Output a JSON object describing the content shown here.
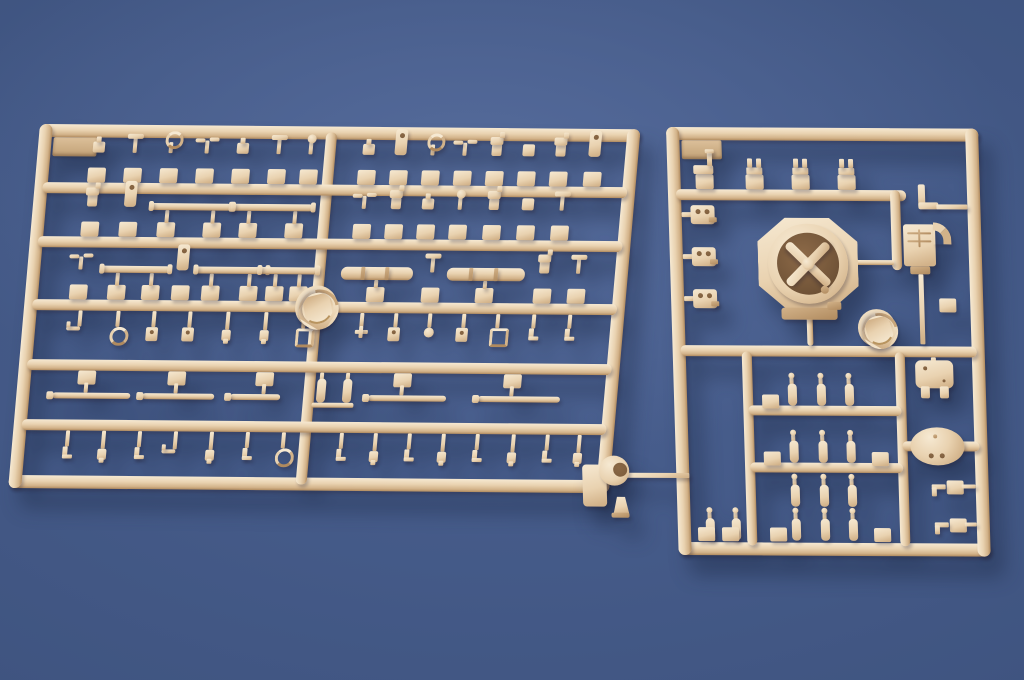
{
  "scene": {
    "width": 1024,
    "height": 680,
    "subject": "two tan plastic model-kit sprues on blue background"
  },
  "palette": {
    "bg1": "#556b9b",
    "bg2": "#4a6090",
    "bg3": "#3f5480",
    "bg4": "#344970",
    "pl_light": "#f6e9d2",
    "pl_mid": "#e9d2b0",
    "pl_dark": "#d2b289",
    "pl_deep": "#b08a5e",
    "hole": "#7c5c3c",
    "ctab1": "#dcc09a",
    "ctab2": "#c2a176"
  },
  "sprues": [
    {
      "id": "left-sprue",
      "x": 40,
      "y": 124,
      "w": 601,
      "h": 364,
      "skew": -4.5,
      "rot": 0.5,
      "corner_tab": {
        "x": 15,
        "y": 13,
        "w": 44,
        "h": 19
      },
      "discs": [
        {
          "cx": 292,
          "cy": 180,
          "r": 21
        }
      ],
      "bars": [
        {
          "x": 0,
          "y": 0,
          "w": 601,
          "h": 13,
          "o": "h",
          "r": 7
        },
        {
          "x": 0,
          "y": 351,
          "w": 601,
          "h": 13,
          "o": "h",
          "r": 7
        },
        {
          "x": 0,
          "y": 0,
          "w": 13,
          "h": 364,
          "o": "v",
          "r": 7
        },
        {
          "x": 588,
          "y": 0,
          "w": 13,
          "h": 364,
          "o": "v",
          "r": 7
        },
        {
          "x": 287,
          "y": 6,
          "w": 11,
          "h": 352,
          "o": "v",
          "r": 5
        },
        {
          "x": 8,
          "y": 58,
          "w": 585,
          "h": 11,
          "o": "h",
          "r": 5
        },
        {
          "x": 8,
          "y": 112,
          "w": 585,
          "h": 11,
          "o": "h",
          "r": 5
        },
        {
          "x": 8,
          "y": 175,
          "w": 585,
          "h": 11,
          "o": "h",
          "r": 5
        },
        {
          "x": 8,
          "y": 235,
          "w": 585,
          "h": 11,
          "o": "h",
          "r": 5
        },
        {
          "x": 8,
          "y": 295,
          "w": 585,
          "h": 11,
          "o": "h",
          "r": 5
        }
      ],
      "parts": [
        {
          "t": "peri",
          "x": 52,
          "y": 58,
          "head": "nub"
        },
        {
          "t": "peri",
          "x": 88,
          "y": 58,
          "head": "tee"
        },
        {
          "t": "peri",
          "x": 124,
          "y": 58,
          "head": "ring"
        },
        {
          "t": "peri",
          "x": 160,
          "y": 58,
          "head": "wing"
        },
        {
          "t": "peri",
          "x": 196,
          "y": 58,
          "head": "nub"
        },
        {
          "t": "peri",
          "x": 232,
          "y": 58,
          "head": "tee"
        },
        {
          "t": "peri",
          "x": 264,
          "y": 58,
          "head": "ball"
        },
        {
          "t": "peri",
          "x": 322,
          "y": 58,
          "head": "nub"
        },
        {
          "t": "peri",
          "x": 354,
          "y": 58,
          "head": "tall"
        },
        {
          "t": "peri",
          "x": 386,
          "y": 58,
          "head": "ring"
        },
        {
          "t": "peri",
          "x": 418,
          "y": 58,
          "head": "wing"
        },
        {
          "t": "peri",
          "x": 450,
          "y": 58,
          "head": "fig"
        },
        {
          "t": "peri",
          "x": 482,
          "y": 58,
          "head": "sq"
        },
        {
          "t": "peri",
          "x": 514,
          "y": 58,
          "head": "fig"
        },
        {
          "t": "peri",
          "x": 548,
          "y": 58,
          "head": "tall"
        },
        {
          "t": "peri",
          "x": 50,
          "y": 112,
          "head": "fig"
        },
        {
          "t": "peri",
          "x": 88,
          "y": 112,
          "head": "tall"
        },
        {
          "t": "barpart",
          "x": 126,
          "y": 112,
          "w": 64
        },
        {
          "t": "barpart",
          "x": 208,
          "y": 112,
          "w": 64
        },
        {
          "t": "peri",
          "x": 322,
          "y": 112,
          "head": "wing"
        },
        {
          "t": "peri",
          "x": 354,
          "y": 112,
          "head": "fig"
        },
        {
          "t": "peri",
          "x": 386,
          "y": 112,
          "head": "nub"
        },
        {
          "t": "peri",
          "x": 418,
          "y": 112,
          "head": "ball"
        },
        {
          "t": "peri",
          "x": 452,
          "y": 112,
          "head": "fig"
        },
        {
          "t": "peri",
          "x": 486,
          "y": 112,
          "head": "sq"
        },
        {
          "t": "peri",
          "x": 520,
          "y": 112,
          "head": "tee"
        },
        {
          "t": "peri",
          "x": 44,
          "y": 175,
          "head": "wing"
        },
        {
          "t": "barpart",
          "x": 82,
          "y": 175,
          "w": 52
        },
        {
          "t": "peri",
          "x": 146,
          "y": 175,
          "head": "tall"
        },
        {
          "t": "barpart",
          "x": 176,
          "y": 175,
          "w": 56
        },
        {
          "t": "barpart",
          "x": 240,
          "y": 175,
          "w": 42
        },
        {
          "t": "pipebar",
          "x": 318,
          "y": 175,
          "w": 64
        },
        {
          "t": "peri",
          "x": 396,
          "y": 175,
          "head": "tee"
        },
        {
          "t": "pipebar",
          "x": 424,
          "y": 175,
          "w": 70
        },
        {
          "t": "peri",
          "x": 508,
          "y": 175,
          "head": "fig"
        },
        {
          "t": "peri",
          "x": 542,
          "y": 175,
          "head": "tee"
        },
        {
          "t": "hang",
          "x": 48,
          "y": 186,
          "len": 16,
          "head": "hook"
        },
        {
          "t": "hang",
          "x": 86,
          "y": 186,
          "len": 16,
          "head": "washer"
        },
        {
          "t": "hang",
          "x": 122,
          "y": 186,
          "len": 16,
          "head": "clip"
        },
        {
          "t": "hang",
          "x": 158,
          "y": 186,
          "len": 16,
          "head": "clip"
        },
        {
          "t": "hang",
          "x": 196,
          "y": 186,
          "len": 18,
          "head": "fig"
        },
        {
          "t": "hang",
          "x": 234,
          "y": 186,
          "len": 18,
          "head": "fig"
        },
        {
          "t": "hang",
          "x": 272,
          "y": 186,
          "len": 16,
          "head": "sqring"
        },
        {
          "t": "hang",
          "x": 330,
          "y": 186,
          "len": 14,
          "head": "cross"
        },
        {
          "t": "hang",
          "x": 364,
          "y": 186,
          "len": 14,
          "head": "clip"
        },
        {
          "t": "hang",
          "x": 398,
          "y": 186,
          "len": 14,
          "head": "ball"
        },
        {
          "t": "hang",
          "x": 432,
          "y": 186,
          "len": 14,
          "head": "clip"
        },
        {
          "t": "hang",
          "x": 466,
          "y": 186,
          "len": 14,
          "head": "sqring"
        },
        {
          "t": "hang",
          "x": 502,
          "y": 186,
          "len": 14,
          "head": "boot"
        },
        {
          "t": "hang",
          "x": 538,
          "y": 186,
          "len": 14,
          "head": "boot"
        },
        {
          "t": "longgun",
          "x": 52,
          "y": 246,
          "w": 78
        },
        {
          "t": "longgun",
          "x": 142,
          "y": 246,
          "w": 72
        },
        {
          "t": "longgun",
          "x": 230,
          "y": 246,
          "w": 50
        },
        {
          "t": "axlepair",
          "x": 300,
          "y": 246
        },
        {
          "t": "longgun",
          "x": 368,
          "y": 246,
          "w": 78
        },
        {
          "t": "longgun",
          "x": 478,
          "y": 246,
          "w": 82
        },
        {
          "t": "hang",
          "x": 46,
          "y": 306,
          "len": 16,
          "head": "boot"
        },
        {
          "t": "hang",
          "x": 82,
          "y": 306,
          "len": 18,
          "head": "fig"
        },
        {
          "t": "hang",
          "x": 118,
          "y": 306,
          "len": 16,
          "head": "boot"
        },
        {
          "t": "hang",
          "x": 154,
          "y": 306,
          "len": 18,
          "head": "hook"
        },
        {
          "t": "hang",
          "x": 190,
          "y": 306,
          "len": 18,
          "head": "fig"
        },
        {
          "t": "hang",
          "x": 226,
          "y": 306,
          "len": 16,
          "head": "boot"
        },
        {
          "t": "hang",
          "x": 262,
          "y": 306,
          "len": 16,
          "head": "washer"
        },
        {
          "t": "hang",
          "x": 320,
          "y": 306,
          "len": 16,
          "head": "boot"
        },
        {
          "t": "hang",
          "x": 354,
          "y": 306,
          "len": 18,
          "head": "fig"
        },
        {
          "t": "hang",
          "x": 388,
          "y": 306,
          "len": 16,
          "head": "boot"
        },
        {
          "t": "hang",
          "x": 422,
          "y": 306,
          "len": 18,
          "head": "fig"
        },
        {
          "t": "hang",
          "x": 456,
          "y": 306,
          "len": 16,
          "head": "boot"
        },
        {
          "t": "hang",
          "x": 492,
          "y": 306,
          "len": 18,
          "head": "fig"
        },
        {
          "t": "hang",
          "x": 526,
          "y": 306,
          "len": 16,
          "head": "boot"
        },
        {
          "t": "hang",
          "x": 558,
          "y": 306,
          "len": 18,
          "head": "fig"
        }
      ]
    },
    {
      "id": "right-sprue",
      "x": 666,
      "y": 127,
      "w": 312,
      "h": 428,
      "skew": 2,
      "rot": 0.3,
      "corner_tab": {
        "x": 15,
        "y": 13,
        "w": 40,
        "h": 19
      },
      "discs": [
        {
          "cx": 205,
          "cy": 200,
          "r": 19
        }
      ],
      "bars": [
        {
          "x": 0,
          "y": 0,
          "w": 312,
          "h": 13,
          "o": "h",
          "r": 7
        },
        {
          "x": 0,
          "y": 415,
          "w": 312,
          "h": 13,
          "o": "h",
          "r": 7
        },
        {
          "x": 0,
          "y": 0,
          "w": 13,
          "h": 428,
          "o": "v",
          "r": 7
        },
        {
          "x": 299,
          "y": 0,
          "w": 13,
          "h": 428,
          "o": "v",
          "r": 7
        },
        {
          "x": 8,
          "y": 62,
          "w": 230,
          "h": 11,
          "o": "h",
          "r": 5
        },
        {
          "x": 222,
          "y": 62,
          "w": 10,
          "h": 80,
          "o": "v",
          "r": 5
        },
        {
          "x": 8,
          "y": 218,
          "w": 296,
          "h": 11,
          "o": "h",
          "r": 5
        },
        {
          "x": 69,
          "y": 224,
          "w": 10,
          "h": 194,
          "o": "v",
          "r": 5
        },
        {
          "x": 222,
          "y": 224,
          "w": 10,
          "h": 194,
          "o": "v",
          "r": 5
        },
        {
          "x": 74,
          "y": 278,
          "w": 153,
          "h": 10,
          "o": "h",
          "r": 5
        },
        {
          "x": 74,
          "y": 335,
          "w": 153,
          "h": 10,
          "o": "h",
          "r": 5
        },
        {
          "x": 227,
          "y": 313,
          "w": 77,
          "h": 10,
          "o": "h",
          "r": 5
        },
        {
          "x": 135,
          "y": 186,
          "w": 6,
          "h": 32,
          "o": "v",
          "r": 3
        },
        {
          "x": 184,
          "y": 132,
          "w": 40,
          "h": 5,
          "o": "h",
          "r": 2
        }
      ],
      "parts": [
        {
          "t": "bench",
          "x": 28,
          "y": 62
        },
        {
          "t": "prong",
          "x": 78,
          "y": 62
        },
        {
          "t": "prong",
          "x": 124,
          "y": 62
        },
        {
          "t": "prong",
          "x": 170,
          "y": 62
        },
        {
          "t": "clip2",
          "x": 13,
          "y": 78
        },
        {
          "t": "clip2",
          "x": 13,
          "y": 120
        },
        {
          "t": "clip2",
          "x": 13,
          "y": 162
        },
        {
          "t": "ringpart",
          "cx": 138,
          "cy": 136
        },
        {
          "t": "bracket",
          "x": 250,
          "y": 56
        },
        {
          "t": "boxhook",
          "x": 234,
          "y": 96
        },
        {
          "t": "tag",
          "x": 268,
          "y": 170
        },
        {
          "t": "gearbox",
          "x": 242,
          "y": 232
        },
        {
          "t": "dome",
          "cx": 262,
          "cy": 318
        },
        {
          "t": "caps",
          "x": 114,
          "y": 256
        },
        {
          "t": "caps",
          "x": 143,
          "y": 256
        },
        {
          "t": "caps",
          "x": 171,
          "y": 256
        },
        {
          "t": "caps",
          "x": 114,
          "y": 313
        },
        {
          "t": "caps",
          "x": 143,
          "y": 313
        },
        {
          "t": "caps",
          "x": 171,
          "y": 313
        },
        {
          "t": "caps",
          "x": 114,
          "y": 357
        },
        {
          "t": "caps",
          "x": 143,
          "y": 357
        },
        {
          "t": "caps",
          "x": 171,
          "y": 357
        },
        {
          "t": "tag",
          "x": 88,
          "y": 267
        },
        {
          "t": "tag",
          "x": 88,
          "y": 324
        },
        {
          "t": "tag",
          "x": 196,
          "y": 324
        },
        {
          "t": "caps",
          "x": 114,
          "y": 391
        },
        {
          "t": "caps",
          "x": 143,
          "y": 391
        },
        {
          "t": "caps",
          "x": 171,
          "y": 391
        },
        {
          "t": "tag",
          "x": 92,
          "y": 400
        },
        {
          "t": "tag",
          "x": 196,
          "y": 400
        },
        {
          "t": "caps",
          "x": 28,
          "y": 391
        },
        {
          "t": "caps",
          "x": 54,
          "y": 391
        },
        {
          "t": "tag",
          "x": 20,
          "y": 400
        },
        {
          "t": "tag",
          "x": 44,
          "y": 400
        },
        {
          "t": "keytab",
          "x": 270,
          "y": 352
        },
        {
          "t": "keytab",
          "x": 272,
          "y": 390
        },
        {
          "t": "mantlet",
          "x": -94,
          "y": 330
        }
      ]
    }
  ]
}
